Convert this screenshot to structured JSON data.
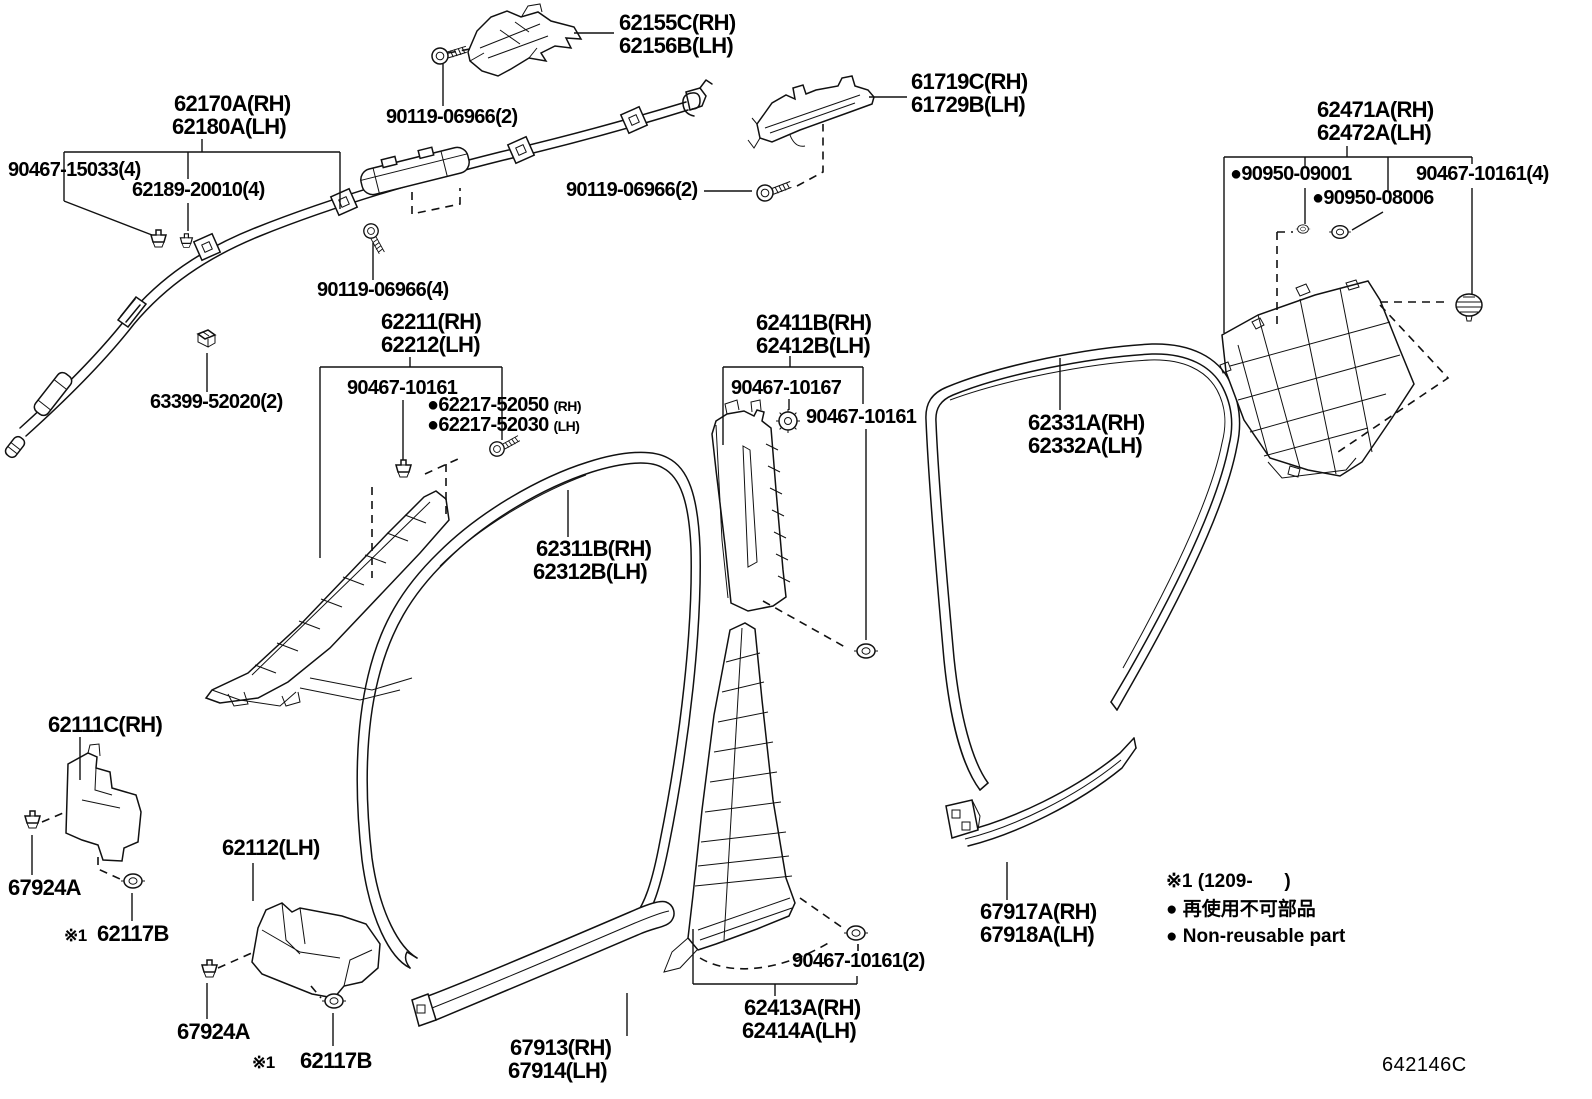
{
  "diagram_code": "642146C",
  "labels": {
    "p62155_rh": "62155C(RH)",
    "p62155_lh": "62156B(LH)",
    "p61719_rh": "61719C(RH)",
    "p61729_lh": "61729B(LH)",
    "p62170_rh": "62170A(RH)",
    "p62180_lh": "62180A(LH)",
    "f90467_15033": "90467-15033(4)",
    "f62189_20010": "62189-20010(4)",
    "f90119_06966_2a": "90119-06966(2)",
    "f90119_06966_2b": "90119-06966(2)",
    "f90119_06966_4": "90119-06966(4)",
    "p62471_rh": "62471A(RH)",
    "p62472_lh": "62472A(LH)",
    "f90950_09001": "●90950-09001",
    "f90467_10161_4": "90467-10161(4)",
    "f90950_08006": "●90950-08006",
    "p62211_rh": "62211(RH)",
    "p62212_lh": "62212(LH)",
    "f90467_10161_a": "90467-10161",
    "f62217_52050": "●62217-52050",
    "f62217_52050_side": "(RH)",
    "f62217_52030": "●62217-52030",
    "f62217_52030_side": "(LH)",
    "f63399_52020": "63399-52020(2)",
    "p62411_rh": "62411B(RH)",
    "p62412_lh": "62412B(LH)",
    "f90467_10167": "90467-10167",
    "f90467_10161_b": "90467-10161",
    "p62331_rh": "62331A(RH)",
    "p62332_lh": "62332A(LH)",
    "p62311_rh": "62311B(RH)",
    "p62312_lh": "62312B(LH)",
    "p62111": "62111C(RH)",
    "p62112": "62112(LH)",
    "f67924a_1": "67924A",
    "f67924a_2": "67924A",
    "note_ref_1": "※1",
    "f62117b_1": "62117B",
    "note_ref_2": "※1",
    "f62117b_2": "62117B",
    "p67913_rh": "67913(RH)",
    "p67914_lh": "67914(LH)",
    "p62413_rh": "62413A(RH)",
    "p62414_lh": "62414A(LH)",
    "f90467_10161_2": "90467-10161(2)",
    "p67917_rh": "67917A(RH)",
    "p67918_lh": "67918A(LH)"
  },
  "legend": {
    "note1": "※1 (1209-      )",
    "note2": "● 再使用不可部品",
    "note3": "● Non-reusable part"
  }
}
